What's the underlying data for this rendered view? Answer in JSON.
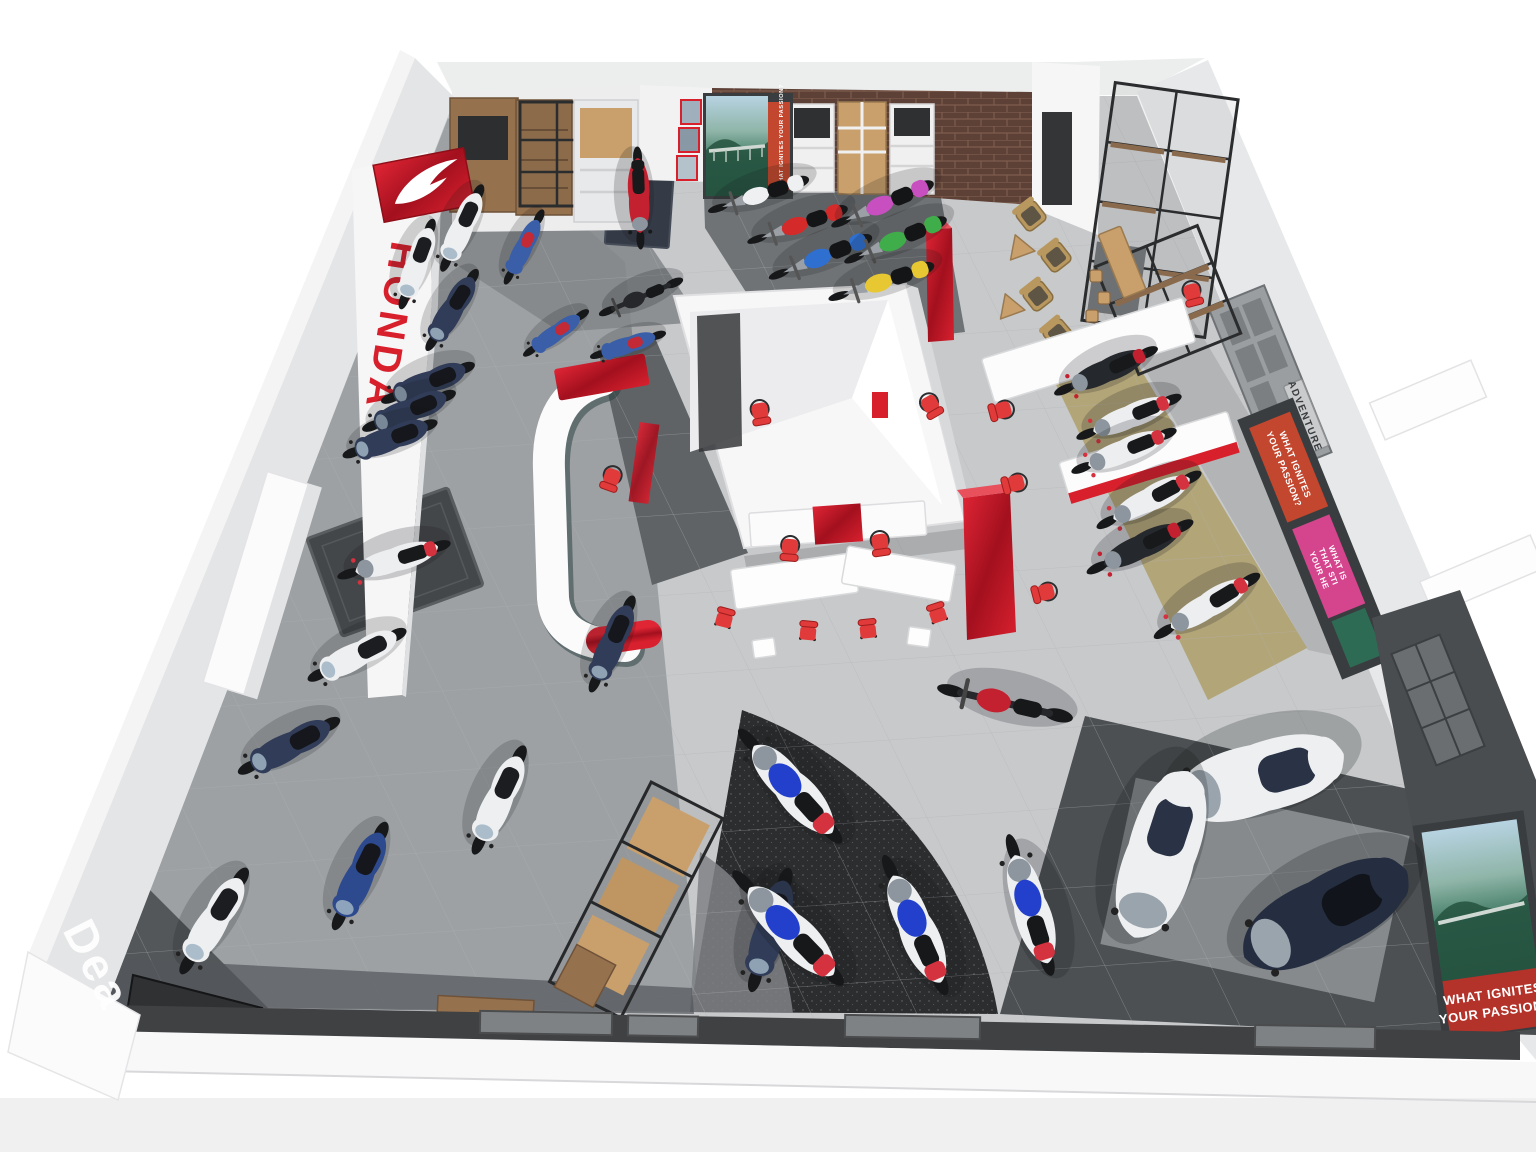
{
  "scene": {
    "description": "Isometric 3D render of a Honda motorcycle dealership showroom floor plan"
  },
  "colors": {
    "honda_red": "#d7202c",
    "glossy_red": "#b5121f",
    "chair_red": "#e03a3a",
    "wall_white": "#f4f4f5",
    "wall_shade": "#e2e3e5",
    "floor_light": "#c7c9cb",
    "floor_mid": "#9da1a4",
    "zone_dark": "#6f7376",
    "carpet_black": "#2b2d2f",
    "khaki": "#b2a578",
    "brick": "#5d4036",
    "brick_line": "#7d5c4b",
    "wood": "#96714e",
    "wood_light": "#c9a06c",
    "metal_black": "#2a2c2e",
    "shelf_gray": "#9b9ea1",
    "shelf_dark": "#4a4d4f",
    "mat_dark": "#44474a",
    "poster_orange": "#c2472e",
    "poster_pink": "#d5458e",
    "poster_red": "#b3322a"
  },
  "signs": {
    "pylon_brand": "HONDA",
    "floor_text": "Dea",
    "shelf_adventure": "ADVENTURE",
    "shelf_touring": "TOURING"
  },
  "posters": {
    "passion_banner": "WHAT IGNITES YOUR PASSION?",
    "passion_lines": [
      "WHAT IGNITES",
      "YOUR PASSION?"
    ],
    "heart_lines": [
      "WHAT IS",
      "THAT STI",
      "YOUR HE"
    ]
  },
  "vehicles": [
    {
      "name": "scooter-white-a",
      "type": "scooter",
      "x": 462,
      "y": 228,
      "r": 205,
      "s": 1.0,
      "body": "#edeff1",
      "accent": "#1b1d20"
    },
    {
      "name": "supercub-blue-a",
      "type": "cub",
      "x": 524,
      "y": 247,
      "r": 207,
      "s": 1.0,
      "body": "#3a5fa8",
      "accent": "#c32a35"
    },
    {
      "name": "scooter-white-b",
      "type": "scooter",
      "x": 417,
      "y": 264,
      "r": 200,
      "s": 1.0,
      "body": "#edeff1",
      "accent": "#1b1d20"
    },
    {
      "name": "scooter-navy-a",
      "type": "scooter",
      "x": 452,
      "y": 310,
      "r": 212,
      "s": 1.0,
      "body": "#303c58",
      "accent": "#15171c"
    },
    {
      "name": "supercub-blue-b",
      "type": "cub",
      "x": 556,
      "y": 333,
      "r": 235,
      "s": 0.95,
      "body": "#3a5fa8",
      "accent": "#c32a35"
    },
    {
      "name": "motorcycle-black-a",
      "type": "naked",
      "x": 641,
      "y": 297,
      "r": 247,
      "s": 0.95,
      "body": "#25272b",
      "accent": "#c32030"
    },
    {
      "name": "supercub-blue-c",
      "type": "cub",
      "x": 628,
      "y": 345,
      "r": 252,
      "s": 0.95,
      "body": "#3a5fa8",
      "accent": "#c32a35"
    },
    {
      "name": "adventure-red-display",
      "type": "adv",
      "x": 639,
      "y": 198,
      "r": 178,
      "s": 1.0,
      "body": "#c32030",
      "accent": "#17191b"
    },
    {
      "name": "scooter-navy-b",
      "type": "scooter",
      "x": 428,
      "y": 383,
      "r": 248,
      "s": 1.05,
      "body": "#303c58",
      "accent": "#15171c"
    },
    {
      "name": "scooter-navy-c",
      "type": "scooter",
      "x": 409,
      "y": 411,
      "r": 248,
      "s": 1.05,
      "body": "#303c58",
      "accent": "#15171c"
    },
    {
      "name": "scooter-navy-d",
      "type": "scooter",
      "x": 390,
      "y": 439,
      "r": 250,
      "s": 1.05,
      "body": "#303c58",
      "accent": "#15171c"
    },
    {
      "name": "adventure-white-display",
      "type": "adv",
      "x": 394,
      "y": 560,
      "r": 253,
      "s": 1.15,
      "body": "#eceef0",
      "accent": "#d4323f"
    },
    {
      "name": "scooter-white-c",
      "type": "scooter",
      "x": 357,
      "y": 655,
      "r": 243,
      "s": 1.15,
      "body": "#edeff1",
      "accent": "#1b1d20"
    },
    {
      "name": "scooter-navy-e",
      "type": "scooter",
      "x": 289,
      "y": 746,
      "r": 242,
      "s": 1.2,
      "body": "#303c58",
      "accent": "#15171c"
    },
    {
      "name": "scooter-white-d",
      "type": "scooter",
      "x": 499,
      "y": 800,
      "r": 205,
      "s": 1.25,
      "body": "#edeff1",
      "accent": "#1b1d20"
    },
    {
      "name": "scooter-blue-a",
      "type": "scooter",
      "x": 360,
      "y": 876,
      "r": 206,
      "s": 1.25,
      "body": "#2e4a8e",
      "accent": "#15171c"
    },
    {
      "name": "scooter-white-e",
      "type": "scooter",
      "x": 214,
      "y": 921,
      "r": 212,
      "s": 1.3,
      "body": "#edeff1",
      "accent": "#1b1d20"
    },
    {
      "name": "scooter-navy-f",
      "type": "scooter",
      "x": 612,
      "y": 644,
      "r": 204,
      "s": 1.1,
      "body": "#303c58",
      "accent": "#15171c"
    },
    {
      "name": "scooter-navy-g",
      "type": "scooter",
      "x": 770,
      "y": 930,
      "r": 197,
      "s": 1.35,
      "body": "#303c58",
      "accent": "#15171c"
    },
    {
      "name": "chopper-white",
      "type": "chopper",
      "x": 762,
      "y": 194,
      "r": 252,
      "s": 1.05,
      "body": "#eef0f2",
      "accent": "#141517"
    },
    {
      "name": "chopper-red",
      "type": "chopper",
      "x": 801,
      "y": 224,
      "r": 251,
      "s": 1.05,
      "body": "#d42a2a",
      "accent": "#141517"
    },
    {
      "name": "chopper-blue",
      "type": "chopper",
      "x": 824,
      "y": 256,
      "r": 248,
      "s": 1.1,
      "body": "#2e6fd0",
      "accent": "#141517"
    },
    {
      "name": "chopper-pink",
      "type": "chopper",
      "x": 886,
      "y": 203,
      "r": 247,
      "s": 1.1,
      "body": "#c84fc0",
      "accent": "#141517"
    },
    {
      "name": "chopper-green",
      "type": "chopper",
      "x": 899,
      "y": 239,
      "r": 247,
      "s": 1.1,
      "body": "#3fae4a",
      "accent": "#141517"
    },
    {
      "name": "chopper-yellow",
      "type": "chopper",
      "x": 885,
      "y": 281,
      "r": 252,
      "s": 1.1,
      "body": "#e8c832",
      "accent": "#141517"
    },
    {
      "name": "sportbike-blue-tank-a",
      "type": "sport",
      "x": 790,
      "y": 786,
      "r": 318,
      "s": 1.5,
      "body": "#edeff1",
      "accent": "#d4323f",
      "tank": "#2340cc"
    },
    {
      "name": "sportbike-blue-tank-b",
      "type": "sport",
      "x": 788,
      "y": 928,
      "r": 316,
      "s": 1.55,
      "body": "#edeff1",
      "accent": "#d4323f",
      "tank": "#2340cc"
    },
    {
      "name": "sportbike-blue-tank-c",
      "type": "sport",
      "x": 915,
      "y": 925,
      "r": 336,
      "s": 1.5,
      "body": "#edeff1",
      "accent": "#d4323f",
      "tank": "#2340cc"
    },
    {
      "name": "sportbike-blue-tank-d",
      "type": "sport",
      "x": 1030,
      "y": 905,
      "r": 343,
      "s": 1.45,
      "body": "#edeff1",
      "accent": "#d4323f",
      "tank": "#2340cc"
    },
    {
      "name": "naked-red",
      "type": "naked",
      "x": 1005,
      "y": 703,
      "r": 283,
      "s": 1.45,
      "body": "#c32030",
      "accent": "#1a1c1e"
    },
    {
      "name": "adventure-dark-a",
      "type": "adv",
      "x": 1106,
      "y": 371,
      "r": 246,
      "s": 1.1,
      "body": "#25282c",
      "accent": "#c32030"
    },
    {
      "name": "adventure-white-a",
      "type": "adv",
      "x": 1129,
      "y": 417,
      "r": 248,
      "s": 1.1,
      "body": "#eceef0",
      "accent": "#d4323f"
    },
    {
      "name": "adventure-white-b",
      "type": "adv",
      "x": 1124,
      "y": 451,
      "r": 248,
      "s": 1.1,
      "body": "#eceef0",
      "accent": "#d4323f"
    },
    {
      "name": "adventure-white-c",
      "type": "adv",
      "x": 1149,
      "y": 500,
      "r": 242,
      "s": 1.15,
      "body": "#eceef0",
      "accent": "#d4323f"
    },
    {
      "name": "adventure-dark-b",
      "type": "adv",
      "x": 1140,
      "y": 547,
      "r": 244,
      "s": 1.15,
      "body": "#25282c",
      "accent": "#c32030"
    },
    {
      "name": "adventure-white-d",
      "type": "adv",
      "x": 1207,
      "y": 606,
      "r": 239,
      "s": 1.2,
      "body": "#eceef0",
      "accent": "#d4323f"
    },
    {
      "name": "tourer-white-a",
      "type": "touring",
      "x": 1256,
      "y": 779,
      "r": 254,
      "s": 1.9,
      "body": "#edeff1",
      "accent": "#2a3346"
    },
    {
      "name": "tourer-white-b",
      "type": "touring",
      "x": 1160,
      "y": 858,
      "r": 198,
      "s": 1.9,
      "body": "#edeff1",
      "accent": "#2a3346"
    },
    {
      "name": "tourer-navy",
      "type": "touring",
      "x": 1322,
      "y": 916,
      "r": 242,
      "s": 2.0,
      "body": "#252e40",
      "accent": "#11141a"
    }
  ]
}
